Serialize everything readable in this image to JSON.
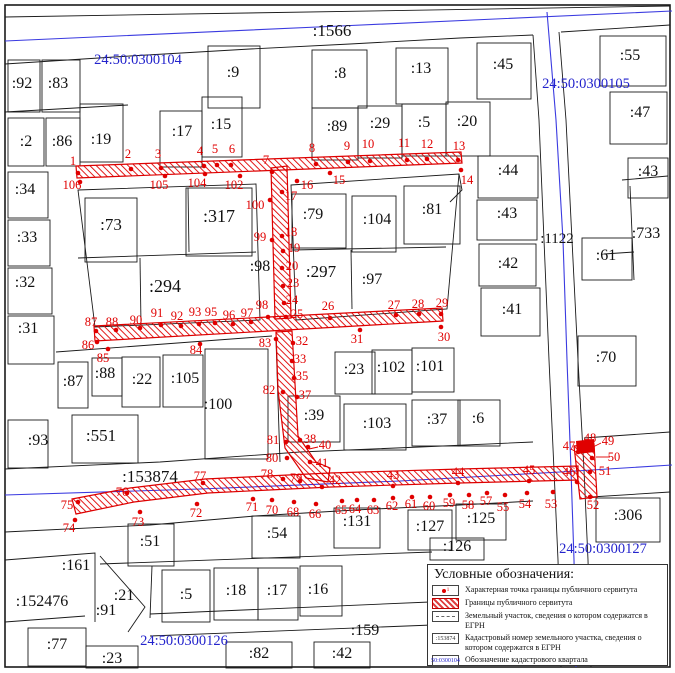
{
  "colors": {
    "servitude": "#e00000",
    "quarter_blue": "#2323cc",
    "parcel_line": "#1a1a1a"
  },
  "legend": {
    "title": "Условные обозначения:",
    "point_symbol_sub": "1",
    "items": [
      {
        "label": "Характерная точка границы публичного сервитута",
        "symbol": "point"
      },
      {
        "label": "Границы публичного сервитута",
        "symbol": "hatched"
      },
      {
        "label": "Земельный участок, сведения о котором содержатся в ЕГРН",
        "symbol": "dashed"
      },
      {
        "label": "Кадастровый номер земельного участка, сведения о котором содержатся в ЕГРН",
        "symbol": "number",
        "symbol_text": ":153874"
      },
      {
        "label": "Обозначение кадастрового квартала",
        "symbol": "quarter",
        "symbol_text": "50:0300104"
      }
    ]
  },
  "map": {
    "quarter_labels": [
      {
        "t": "24:50:0300104",
        "x": 138,
        "y": 64
      },
      {
        "t": "24:50:0300105",
        "x": 586,
        "y": 88
      },
      {
        "t": "24:50:0300127",
        "x": 603,
        "y": 553
      },
      {
        "t": "24:50:0300126",
        "x": 184,
        "y": 645
      }
    ],
    "parcel_labels": [
      {
        "t": ":1566",
        "x": 332,
        "y": 36,
        "s": 17
      },
      {
        "t": ":92",
        "x": 22,
        "y": 88,
        "s": 16
      },
      {
        "t": ":83",
        "x": 58,
        "y": 88,
        "s": 16
      },
      {
        "t": ":9",
        "x": 233,
        "y": 77,
        "s": 16
      },
      {
        "t": ":8",
        "x": 340,
        "y": 78,
        "s": 16
      },
      {
        "t": ":13",
        "x": 421,
        "y": 73,
        "s": 16
      },
      {
        "t": ":45",
        "x": 503,
        "y": 69,
        "s": 16
      },
      {
        "t": ":55",
        "x": 630,
        "y": 60,
        "s": 16
      },
      {
        "t": ":47",
        "x": 640,
        "y": 117,
        "s": 16
      },
      {
        "t": ":2",
        "x": 26,
        "y": 146,
        "s": 16
      },
      {
        "t": ":86",
        "x": 62,
        "y": 146,
        "s": 16
      },
      {
        "t": ":19",
        "x": 101,
        "y": 144,
        "s": 16
      },
      {
        "t": ":17",
        "x": 182,
        "y": 136,
        "s": 16
      },
      {
        "t": ":15",
        "x": 221,
        "y": 129,
        "s": 16
      },
      {
        "t": ":89",
        "x": 337,
        "y": 131,
        "s": 16
      },
      {
        "t": ":29",
        "x": 380,
        "y": 128,
        "s": 16
      },
      {
        "t": ":5",
        "x": 424,
        "y": 127,
        "s": 16
      },
      {
        "t": ":20",
        "x": 467,
        "y": 126,
        "s": 16
      },
      {
        "t": ":34",
        "x": 25,
        "y": 194,
        "s": 16
      },
      {
        "t": ":33",
        "x": 27,
        "y": 242,
        "s": 16
      },
      {
        "t": ":32",
        "x": 25,
        "y": 287,
        "s": 16
      },
      {
        "t": ":31",
        "x": 28,
        "y": 333,
        "s": 16
      },
      {
        "t": ":73",
        "x": 111,
        "y": 230,
        "s": 17
      },
      {
        "t": ":317",
        "x": 219,
        "y": 222,
        "s": 18
      },
      {
        "t": ":294",
        "x": 165,
        "y": 292,
        "s": 18
      },
      {
        "t": ":98",
        "x": 260,
        "y": 271,
        "s": 16
      },
      {
        "t": ":79",
        "x": 313,
        "y": 219,
        "s": 16
      },
      {
        "t": ":104",
        "x": 377,
        "y": 224,
        "s": 16
      },
      {
        "t": ":81",
        "x": 432,
        "y": 214,
        "s": 16
      },
      {
        "t": ":297",
        "x": 321,
        "y": 277,
        "s": 17
      },
      {
        "t": ":97",
        "x": 372,
        "y": 284,
        "s": 16
      },
      {
        "t": ":44",
        "x": 508,
        "y": 175,
        "s": 16
      },
      {
        "t": ":43",
        "x": 507,
        "y": 218,
        "s": 16
      },
      {
        "t": ":42",
        "x": 508,
        "y": 268,
        "s": 16
      },
      {
        "t": ":41",
        "x": 512,
        "y": 314,
        "s": 16
      },
      {
        "t": ":1122",
        "x": 557,
        "y": 243,
        "s": 15
      },
      {
        "t": ":43",
        "x": 648,
        "y": 176,
        "s": 16
      },
      {
        "t": ":733",
        "x": 646,
        "y": 238,
        "s": 16
      },
      {
        "t": ":61",
        "x": 606,
        "y": 260,
        "s": 16
      },
      {
        "t": ":70",
        "x": 606,
        "y": 362,
        "s": 16
      },
      {
        "t": ":87",
        "x": 73,
        "y": 386,
        "s": 16
      },
      {
        "t": ":88",
        "x": 105,
        "y": 378,
        "s": 16
      },
      {
        "t": ":22",
        "x": 142,
        "y": 384,
        "s": 16
      },
      {
        "t": ":105",
        "x": 185,
        "y": 383,
        "s": 16
      },
      {
        "t": ":100",
        "x": 218,
        "y": 409,
        "s": 16
      },
      {
        "t": ":93",
        "x": 38,
        "y": 445,
        "s": 16
      },
      {
        "t": ":551",
        "x": 101,
        "y": 441,
        "s": 17
      },
      {
        "t": ":153874",
        "x": 150,
        "y": 482,
        "s": 17
      },
      {
        "t": ":23",
        "x": 354,
        "y": 374,
        "s": 16
      },
      {
        "t": ":102",
        "x": 391,
        "y": 372,
        "s": 16
      },
      {
        "t": ":101",
        "x": 430,
        "y": 371,
        "s": 16
      },
      {
        "t": ":39",
        "x": 314,
        "y": 420,
        "s": 16
      },
      {
        "t": ":103",
        "x": 377,
        "y": 428,
        "s": 16
      },
      {
        "t": ":37",
        "x": 437,
        "y": 424,
        "s": 16
      },
      {
        "t": ":6",
        "x": 478,
        "y": 423,
        "s": 16
      },
      {
        "t": ":306",
        "x": 628,
        "y": 520,
        "s": 16
      },
      {
        "t": ":131",
        "x": 357,
        "y": 526,
        "s": 16
      },
      {
        "t": ":127",
        "x": 430,
        "y": 531,
        "s": 16
      },
      {
        "t": ":125",
        "x": 481,
        "y": 523,
        "s": 16
      },
      {
        "t": ":126",
        "x": 457,
        "y": 551,
        "s": 16
      },
      {
        "t": ":51",
        "x": 150,
        "y": 546,
        "s": 16
      },
      {
        "t": ":54",
        "x": 277,
        "y": 538,
        "s": 16
      },
      {
        "t": ":161",
        "x": 76,
        "y": 570,
        "s": 16
      },
      {
        "t": ":152476",
        "x": 42,
        "y": 606,
        "s": 16
      },
      {
        "t": ":91",
        "x": 106,
        "y": 615,
        "s": 16
      },
      {
        "t": ":21",
        "x": 124,
        "y": 600,
        "s": 16
      },
      {
        "t": ":5",
        "x": 186,
        "y": 599,
        "s": 16
      },
      {
        "t": ":18",
        "x": 236,
        "y": 595,
        "s": 16
      },
      {
        "t": ":17",
        "x": 277,
        "y": 595,
        "s": 16
      },
      {
        "t": ":16",
        "x": 318,
        "y": 594,
        "s": 16
      },
      {
        "t": ":77",
        "x": 57,
        "y": 649,
        "s": 16
      },
      {
        "t": ":23",
        "x": 112,
        "y": 663,
        "s": 16
      },
      {
        "t": ":82",
        "x": 259,
        "y": 658,
        "s": 16
      },
      {
        "t": ":42",
        "x": 342,
        "y": 658,
        "s": 16
      },
      {
        "t": ":159",
        "x": 365,
        "y": 635,
        "s": 16
      }
    ],
    "servitude_points": [
      [
        "1",
        78,
        173,
        73,
        165
      ],
      [
        "2",
        131,
        169,
        128,
        158
      ],
      [
        "3",
        161,
        168,
        158,
        158
      ],
      [
        "4",
        204,
        166,
        200,
        155
      ],
      [
        "5",
        217,
        165,
        215,
        153
      ],
      [
        "6",
        231,
        165,
        232,
        153
      ],
      [
        "7",
        272,
        172,
        266,
        164
      ],
      [
        "8",
        316,
        164,
        312,
        152
      ],
      [
        "9",
        348,
        162,
        347,
        150
      ],
      [
        "10",
        370,
        161,
        368,
        148
      ],
      [
        "11",
        407,
        160,
        404,
        147
      ],
      [
        "12",
        427,
        159,
        427,
        148
      ],
      [
        "13",
        458,
        160,
        459,
        150
      ],
      [
        "14",
        461,
        170,
        467,
        184
      ],
      [
        "15",
        330,
        173,
        339,
        184
      ],
      [
        "16",
        297,
        181,
        307,
        189
      ],
      [
        "17",
        282,
        192,
        291,
        200
      ],
      [
        "18",
        282,
        236,
        291,
        236
      ],
      [
        "19",
        283,
        251,
        294,
        252
      ],
      [
        "20",
        282,
        268,
        292,
        270
      ],
      [
        "23",
        283,
        286,
        293,
        287
      ],
      [
        "24",
        284,
        303,
        292,
        304
      ],
      [
        "25",
        286,
        317,
        297,
        318
      ],
      [
        "26",
        330,
        318,
        328,
        310
      ],
      [
        "27",
        396,
        315,
        394,
        309
      ],
      [
        "28",
        419,
        314,
        418,
        308
      ],
      [
        "29",
        441,
        314,
        442,
        307
      ],
      [
        "30",
        441,
        327,
        444,
        341
      ],
      [
        "31",
        360,
        330,
        357,
        343
      ],
      [
        "32",
        293,
        343,
        302,
        345
      ],
      [
        "33",
        292,
        361,
        300,
        363
      ],
      [
        "35",
        294,
        378,
        302,
        380
      ],
      [
        "37",
        297,
        397,
        305,
        399
      ],
      [
        "38",
        300,
        440,
        310,
        443
      ],
      [
        "40",
        308,
        447,
        325,
        449
      ],
      [
        "41",
        310,
        462,
        322,
        467
      ],
      [
        "42",
        322,
        487,
        335,
        484
      ],
      [
        "43",
        393,
        486,
        393,
        479
      ],
      [
        "44",
        458,
        483,
        458,
        476
      ],
      [
        "45",
        529,
        481,
        529,
        474
      ],
      [
        "46",
        577,
        482,
        569,
        476
      ],
      [
        "47",
        578,
        452,
        569,
        450
      ],
      [
        "48",
        584,
        448,
        590,
        442
      ],
      [
        "49",
        590,
        448,
        608,
        445
      ],
      [
        "50",
        592,
        458,
        614,
        461
      ],
      [
        "51",
        590,
        472,
        605,
        475
      ],
      [
        "52",
        590,
        497,
        593,
        509
      ],
      [
        "53",
        553,
        492,
        551,
        508
      ],
      [
        "54",
        527,
        493,
        525,
        508
      ],
      [
        "55",
        505,
        495,
        503,
        511
      ],
      [
        "57",
        487,
        493,
        486,
        505
      ],
      [
        "58",
        469,
        495,
        468,
        509
      ],
      [
        "59",
        450,
        495,
        449,
        507
      ],
      [
        "60",
        430,
        497,
        429,
        510
      ],
      [
        "61",
        412,
        497,
        411,
        508
      ],
      [
        "62",
        393,
        498,
        392,
        510
      ],
      [
        "63",
        374,
        500,
        373,
        514
      ],
      [
        "64",
        357,
        500,
        355,
        513
      ],
      [
        "65",
        342,
        501,
        341,
        514
      ],
      [
        "66",
        316,
        504,
        315,
        518
      ],
      [
        "68",
        294,
        502,
        293,
        516
      ],
      [
        "70",
        272,
        500,
        272,
        514
      ],
      [
        "71",
        253,
        499,
        252,
        511
      ],
      [
        "72",
        197,
        504,
        196,
        517
      ],
      [
        "73",
        140,
        512,
        138,
        526
      ],
      [
        "74",
        75,
        520,
        69,
        532
      ],
      [
        "75",
        78,
        502,
        67,
        509
      ],
      [
        "76",
        127,
        493,
        122,
        496
      ],
      [
        "77",
        203,
        483,
        200,
        480
      ],
      [
        "78",
        283,
        479,
        267,
        478
      ],
      [
        "79",
        300,
        481,
        296,
        482
      ],
      [
        "80",
        287,
        458,
        272,
        462
      ],
      [
        "81",
        286,
        442,
        273,
        444
      ],
      [
        "82",
        283,
        392,
        269,
        394
      ],
      [
        "83",
        276,
        339,
        265,
        347
      ],
      [
        "84",
        200,
        344,
        196,
        354
      ],
      [
        "85",
        108,
        349,
        103,
        362
      ],
      [
        "86",
        97,
        342,
        88,
        349
      ],
      [
        "87",
        96,
        331,
        91,
        326
      ],
      [
        "88",
        116,
        330,
        112,
        326
      ],
      [
        "90",
        140,
        328,
        136,
        324
      ],
      [
        "91",
        161,
        325,
        157,
        317
      ],
      [
        "92",
        181,
        326,
        177,
        320
      ],
      [
        "93",
        199,
        324,
        195,
        316
      ],
      [
        "95",
        215,
        323,
        211,
        316
      ],
      [
        "96",
        233,
        324,
        229,
        319
      ],
      [
        "97",
        251,
        322,
        247,
        317
      ],
      [
        "98",
        268,
        317,
        262,
        309
      ],
      [
        "99",
        272,
        240,
        260,
        241
      ],
      [
        "100",
        270,
        200,
        255,
        209
      ],
      [
        "102",
        240,
        176,
        234,
        189
      ],
      [
        "104",
        205,
        174,
        197,
        187
      ],
      [
        "105",
        165,
        176,
        159,
        189
      ],
      [
        "106",
        80,
        182,
        72,
        189
      ]
    ]
  }
}
